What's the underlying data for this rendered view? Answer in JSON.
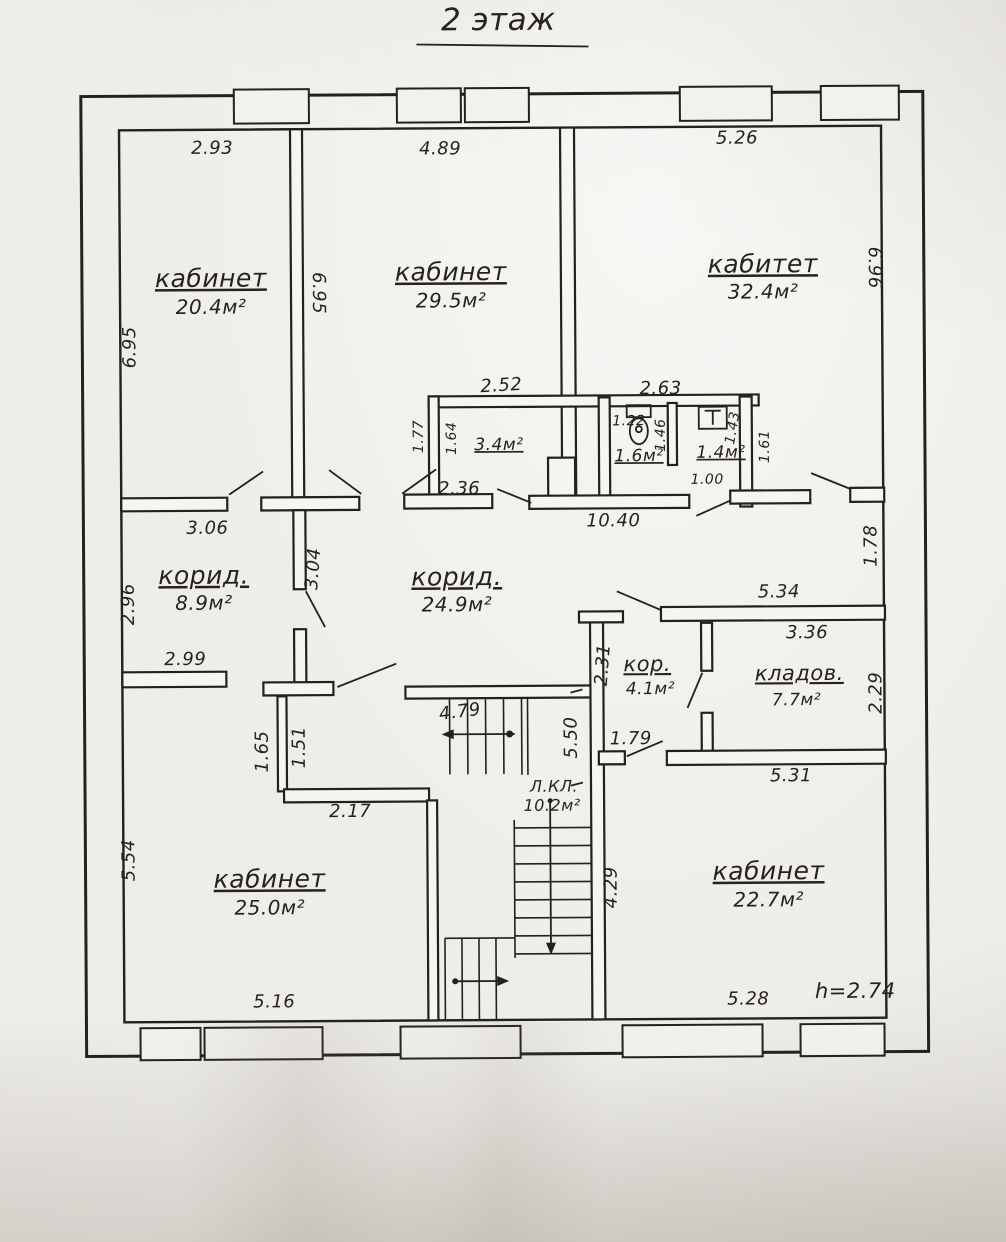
{
  "title": "2 этаж",
  "rooms": {
    "office_top_left": {
      "name": "кабинет",
      "area": "20.4м²"
    },
    "office_top_mid": {
      "name": "кабинет",
      "area": "29.5м²"
    },
    "office_top_right": {
      "name": "кабитет",
      "area": "32.4м²"
    },
    "wc_lobby": {
      "area": "3.4м²"
    },
    "wc_toilet": {
      "area": "1.6м²"
    },
    "wc_sink": {
      "area": "1.4м²"
    },
    "corridor_left": {
      "name": "корид.",
      "area": "8.9м²"
    },
    "corridor_main": {
      "name": "корид.",
      "area": "24.9м²"
    },
    "corridor_small": {
      "name": "кор.",
      "area": "4.1м²"
    },
    "storage": {
      "name": "кладов.",
      "area": "7.7м²"
    },
    "stairwell": {
      "name": "Л.КЛ.",
      "area": "10.2м²"
    },
    "office_bottom_left": {
      "name": "кабинет",
      "area": "25.0м²"
    },
    "office_bottom_right": {
      "name": "кабинет",
      "area": "22.7м²"
    }
  },
  "dimensions": {
    "top_left_width": "2.93",
    "top_mid_width": "4.89",
    "top_right_width": "5.26",
    "left_wall_height": "6.95",
    "mid_wall_height": "6.95",
    "right_wall_height": "6.96",
    "wc_lobby_top": "2.52",
    "wc_top": "2.63",
    "wc_lobby_left_outer": "1.77",
    "wc_lobby_left_inner": "1.64",
    "wc_lobby_bottom": "2.36",
    "wc_toilet_width": "1.22",
    "wc_toilet_depth": "1.46",
    "wc_sink_depth": "1.43",
    "wc_door": "1.00",
    "wc_right": "1.61",
    "corridor_main_bottom": "10.40",
    "corridor_left_top": "3.06",
    "corridor_left_side": "2.96",
    "corridor_left_wall": "3.04",
    "corridor_left_bottom": "2.99",
    "storage_top_outer": "5.34",
    "storage_top_inner": "3.36",
    "storage_right": "2.29",
    "storage_bottom": "5.31",
    "right_wall_mid": "1.78",
    "corridor_small_height": "2.31",
    "corridor_small_door": "1.79",
    "stairs_top": "4.79",
    "stairs_length": "5.50",
    "recess_left": "1.65",
    "recess_right": "1.51",
    "recess_bottom": "2.17",
    "stairs_side": "4.29",
    "bottom_left_side": "5.54",
    "bottom_left_width": "5.16",
    "bottom_right_width": "5.28",
    "ceiling_height": "h=2.74"
  }
}
